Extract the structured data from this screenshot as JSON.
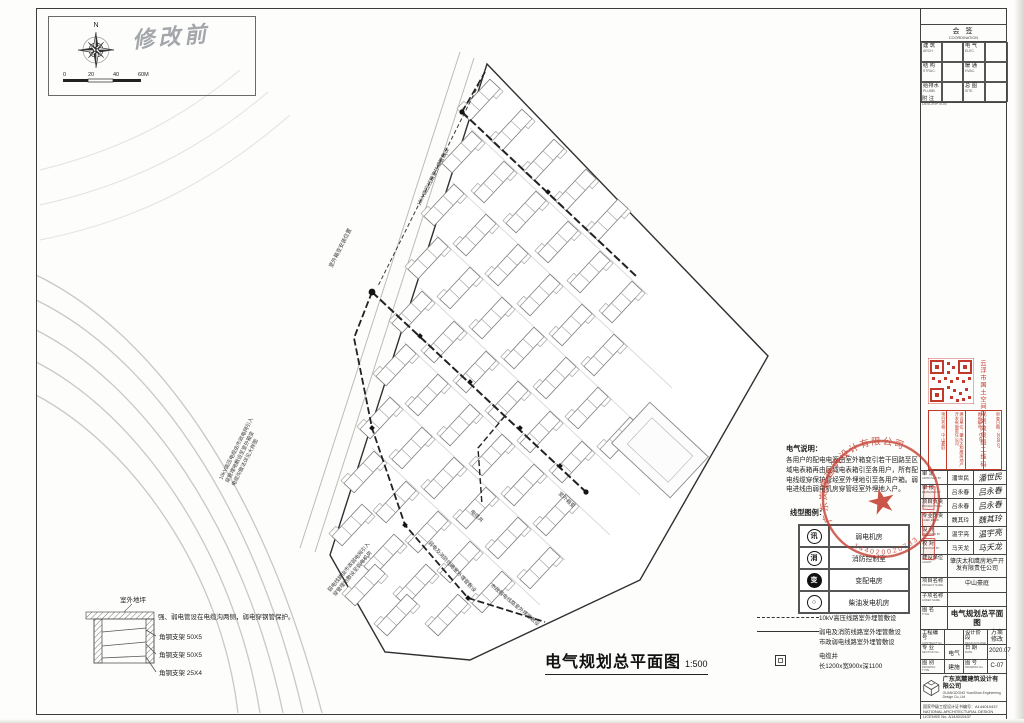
{
  "page": {
    "handwritten": "修改前"
  },
  "compass": {
    "n": "N",
    "t0": "0",
    "t1": "20",
    "t2": "40",
    "t3": "60M"
  },
  "coordination": {
    "title": "会 签",
    "subtitle": "COORDINATION",
    "rows": [
      {
        "l1": "建 筑",
        "e1": "ARCH.",
        "l2": "电 气",
        "e2": "ELEC."
      },
      {
        "l1": "结 构",
        "e1": "STRUC.",
        "l2": "暖 通",
        "e2": "HVAC."
      },
      {
        "l1": "给排水",
        "e1": "PLUMB.",
        "l2": "总 图",
        "e2": "SITE."
      }
    ],
    "note": "附 注",
    "note_en": "DESCRIPTION"
  },
  "notes": {
    "title": "电气说明：",
    "body": "各用户的配电电源由室外箱变引若干回路至区域电表箱再由区域电表箱引至各用户，所有配电线缆穿保护管经室外埋地引至各用户箱。弱电进线由弱电机房穿管经室外埋地入户。"
  },
  "room_legend": {
    "title": "线型图例：",
    "items": [
      {
        "sym": "讯",
        "label": "弱电机房"
      },
      {
        "sym": "消",
        "label": "消防控制室"
      },
      {
        "sym": "变",
        "label": "变配电房"
      },
      {
        "sym": "○",
        "label": "柴油发电机房"
      }
    ]
  },
  "line_legend": {
    "rows": [
      {
        "label": "10kV高压线路室外埋管敷设",
        "label2": ""
      },
      {
        "label": "弱电及消防线路室外埋管敷设",
        "label2": "市政弱电线路室外埋管敷设"
      },
      {
        "label": "电缆井",
        "label2": "长1200x宽900x深1100"
      }
    ]
  },
  "trench": {
    "ground": "室外地坪",
    "note": "强、弱电管设在电缆沟两侧，弱电穿钢管保护。",
    "b1": "角钢支架 50X5",
    "b2": "角钢支架 50X5",
    "b3": "角钢支架 25X4"
  },
  "main_title": {
    "text": "电气规划总平面图",
    "scale": "1:500"
  },
  "plan": {
    "annotations": {
      "a1": "室外箱变安装位置",
      "a2": "10kV高压电缆由市政电网引入",
      "a3": "穿管埋地敷设至室外箱变",
      "a4": "电缆沟做法详见大样图",
      "a5": "弱电线路由市政弱电网引入",
      "a6": "穿管埋地敷设至弱电机房",
      "a7": "弱电及消防线路室外埋管敷设",
      "a8": "市政弱电线路室外埋管敷设",
      "a9": "电缆井",
      "a10": "室外箱变",
      "a11": "10kV高压线路室外埋管敷设"
    }
  },
  "qr": {
    "side": "云浮市国土空间规划效果图二维码",
    "c1": "项目名称：中山豪庭",
    "c2": "建设单位：肇庆太和鹰房地产开发有限责任公司",
    "c3": "图纸编号：C-07",
    "c4": "审查日期：2020.07"
  },
  "seal": {
    "company": "广东岚麓建筑设计有限公司",
    "num": "144020020783",
    "star": "★"
  },
  "titleblock": {
    "sign_rows": [
      {
        "label": "审 定",
        "en": "APPROVED BY",
        "name": "潘世民",
        "sig": "潘世民"
      },
      {
        "label": "审 核",
        "en": "REVIEWED BY",
        "name": "吕永春",
        "sig": "吕永春"
      },
      {
        "label": "项目负责",
        "en": "PROJECT MGR.",
        "name": "吕永春",
        "sig": "吕永春"
      },
      {
        "label": "专业负责",
        "en": "CHIEF ENGR.",
        "name": "魏其玲",
        "sig": "魏其玲"
      },
      {
        "label": "设 计",
        "en": "DESIGNED BY",
        "name": "温宇亮",
        "sig": "温宇亮"
      },
      {
        "label": "校 对",
        "en": "CHECKED BY",
        "name": "马天龙",
        "sig": "马天龙"
      }
    ],
    "client_label": "建设单位",
    "client_en": "CLIENT",
    "client": "肇庆太和鹰房地产开发有限责任公司",
    "project_label": "项目名称",
    "project_en": "PROJECT NAME",
    "project": "中山豪庭",
    "subproject_label": "子项名称",
    "subproject_en": "ANNEX NAME",
    "subproject": "",
    "title_label": "图 名",
    "title_en": "TITLE",
    "title": "电气规划总平面图",
    "contract_label": "工程编号",
    "contract_en": "CONTRACT No.",
    "contract": "",
    "phase_label": "设计阶段",
    "phase_en": "DESIGN PHASE",
    "phase": "方案修改",
    "section_label": "专 业",
    "section_en": "SECTION No.",
    "section": "电气",
    "date_label": "日 期",
    "date_en": "DATE",
    "date": "2020.07",
    "type_label": "图 别",
    "type_en": "DRAWING TYPE",
    "type": "建施",
    "no_label": "图 号",
    "no_en": "DRAWING No.",
    "no": "C-07",
    "company": "广东岚麓建筑设计有限公司",
    "company_en": "GUANGDONG YuanShan Engineering Design Co.,Ltd",
    "license1": "国家甲级工程设计证书编号：A144010437",
    "license2": "NATIONAL ARCHITECTURAL DESIGN LICENSE No. A144010437",
    "copyright1": "本图纸版权归本公司所有，不得用于本工程以外项目。",
    "copyright2": "THE DRAWING COPYRIGHT IS OWNED BY OUR COMPANY,",
    "copyright3": "SHALL NOT BE USED FOR OTHER PROJECTS."
  }
}
